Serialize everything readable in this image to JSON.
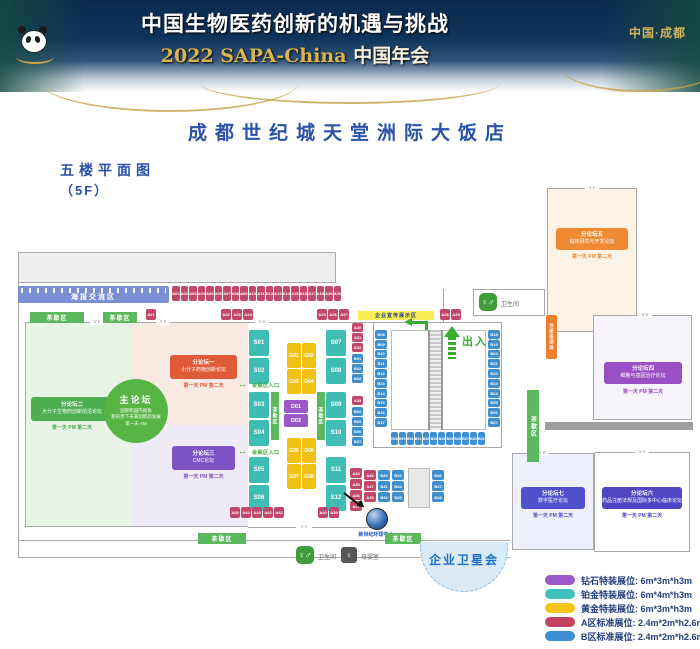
{
  "header": {
    "title_line1": "中国生物医药创新的机遇与挑战",
    "title_line2_en": "2022 SAPA-China",
    "title_line2_cn": "中国年会",
    "location": "中国·成都"
  },
  "page": {
    "hotel_title": "成都世纪城天堂洲际大饭店",
    "floor_label_line1": "五楼平面图",
    "floor_label_line2": "（5F）"
  },
  "plan": {
    "labels": {
      "poster_zone": "海报交流区",
      "tea_break": "茶歇区",
      "promo_zone": "企业宣传展示区",
      "gate": "出入口",
      "expo_gate": "会展区入口",
      "satellite": "企业卫星会",
      "restroom": "卫生间",
      "nursing": "母婴室",
      "reg_tag": "注册签到处",
      "landmark_caption": "新世纪环球中心",
      "wc_glyph": "♀♂",
      "nurse_glyph": "♀",
      "expo_arrow_glyph": "↔"
    },
    "forums": {
      "main": {
        "title": "主论坛",
        "line1": "国际和国内视角",
        "line2": "新形势下未来创新药发展",
        "time": "第一天 AM"
      },
      "f1": {
        "title": "分论坛一",
        "subtitle": "小分子药物创新论坛",
        "time": "第一天 PM 第二天"
      },
      "f2": {
        "title": "分论坛二",
        "subtitle": "大分子生物药创新前沿论坛",
        "time": "第一天 PM 第二天"
      },
      "f3": {
        "title": "分论坛三",
        "subtitle": "CMC论坛",
        "time": "第一天 PM 第二天"
      },
      "f4": {
        "title": "分论坛四",
        "subtitle": "细胞与基因治疗论坛",
        "time": "第一天 PM 第二天"
      },
      "f5": {
        "title": "分论坛五",
        "subtitle": "临床研究与开发论坛",
        "time": "第一天 PM 第二天"
      },
      "f6": {
        "title": "分论坛六",
        "subtitle": "药品注册法规及国际多中心临床论坛",
        "time": "第一天 PM 第二天"
      },
      "f7": {
        "title": "分论坛七",
        "subtitle": "数字医疗论坛",
        "time": "第一天 PM 第二天"
      }
    },
    "booths": {
      "a_top": [
        "A01",
        "A02",
        "A03",
        "A04",
        "A05",
        "A06",
        "A07",
        "A08",
        "A09",
        "A10",
        "A11",
        "A12",
        "A13",
        "A14",
        "A15",
        "A16",
        "A17",
        "A18",
        "A19",
        "A20"
      ],
      "a_single": [
        "A21"
      ],
      "a_trio1": [
        "A22",
        "A23",
        "A24"
      ],
      "a_trio2": [
        "A25",
        "A26",
        "A27"
      ],
      "a_pair": [
        "A28",
        "A29"
      ],
      "strip_a1": [
        "A30",
        "A31",
        "A32"
      ],
      "strip_b1": [
        "B01",
        "B02",
        "B03"
      ],
      "strip_a2": [
        "A33"
      ],
      "strip_b2": [
        "B04",
        "B05",
        "B06",
        "B07"
      ],
      "hall_left": [
        "B08",
        "B09",
        "B10",
        "B11",
        "B12",
        "B13",
        "B14",
        "B15",
        "B16",
        "B17"
      ],
      "hall_right": [
        "B18",
        "B19",
        "B20",
        "B21",
        "B22",
        "B23",
        "B24",
        "B25",
        "B26",
        "B27"
      ],
      "hall_bottom": [
        "B28",
        "B29",
        "B30",
        "B31",
        "B32",
        "B33",
        "B34",
        "B35",
        "B36",
        "B37",
        "B38",
        "B39"
      ],
      "s_left_1": [
        "S01",
        "S02"
      ],
      "s_left_2": [
        "S03",
        "S04"
      ],
      "s_left_3": [
        "S05",
        "S06"
      ],
      "s_right_1": [
        "S07",
        "S08"
      ],
      "s_right_2": [
        "S09",
        "S10"
      ],
      "s_right_3": [
        "S11",
        "S12"
      ],
      "g_top_r1": [
        "G01",
        "G02"
      ],
      "g_top_r2": [
        "G03",
        "G04"
      ],
      "g_bot_r1": [
        "G05",
        "G06"
      ],
      "g_bot_r2": [
        "G07",
        "G08"
      ],
      "d_col": [
        "D01",
        "D02"
      ],
      "bottom_cluster": [
        "A45",
        "A44",
        "A43",
        "A42",
        "A41"
      ],
      "bottom_pair": [
        "A40",
        "A39"
      ],
      "sat_a_strip": [
        "A34",
        "A35",
        "A36",
        "A37"
      ],
      "sat_a_col": [
        "A46",
        "A47",
        "A48"
      ],
      "sat_b1": [
        "B40",
        "B41",
        "B42"
      ],
      "sat_b2": [
        "B43",
        "B44",
        "B45"
      ],
      "sat_b3": [
        "B46",
        "B47",
        "B48"
      ]
    },
    "legend": [
      {
        "color": "#9b59c7",
        "label": "钻石特装展位:",
        "size": "6m*3m*h3m"
      },
      {
        "color": "#3fc1bc",
        "label": "铂金特装展位:",
        "size": "6m*4m*h3m"
      },
      {
        "color": "#f5c518",
        "label": "黄金特装展位:",
        "size": "6m*3m*h3m"
      },
      {
        "color": "#c0445f",
        "label": "A区标准展位:",
        "size": "2.4m*2m*h2.6m"
      },
      {
        "color": "#3d8fd1",
        "label": "B区标准展位:",
        "size": "2.4m*2m*h2.6m"
      }
    ]
  }
}
